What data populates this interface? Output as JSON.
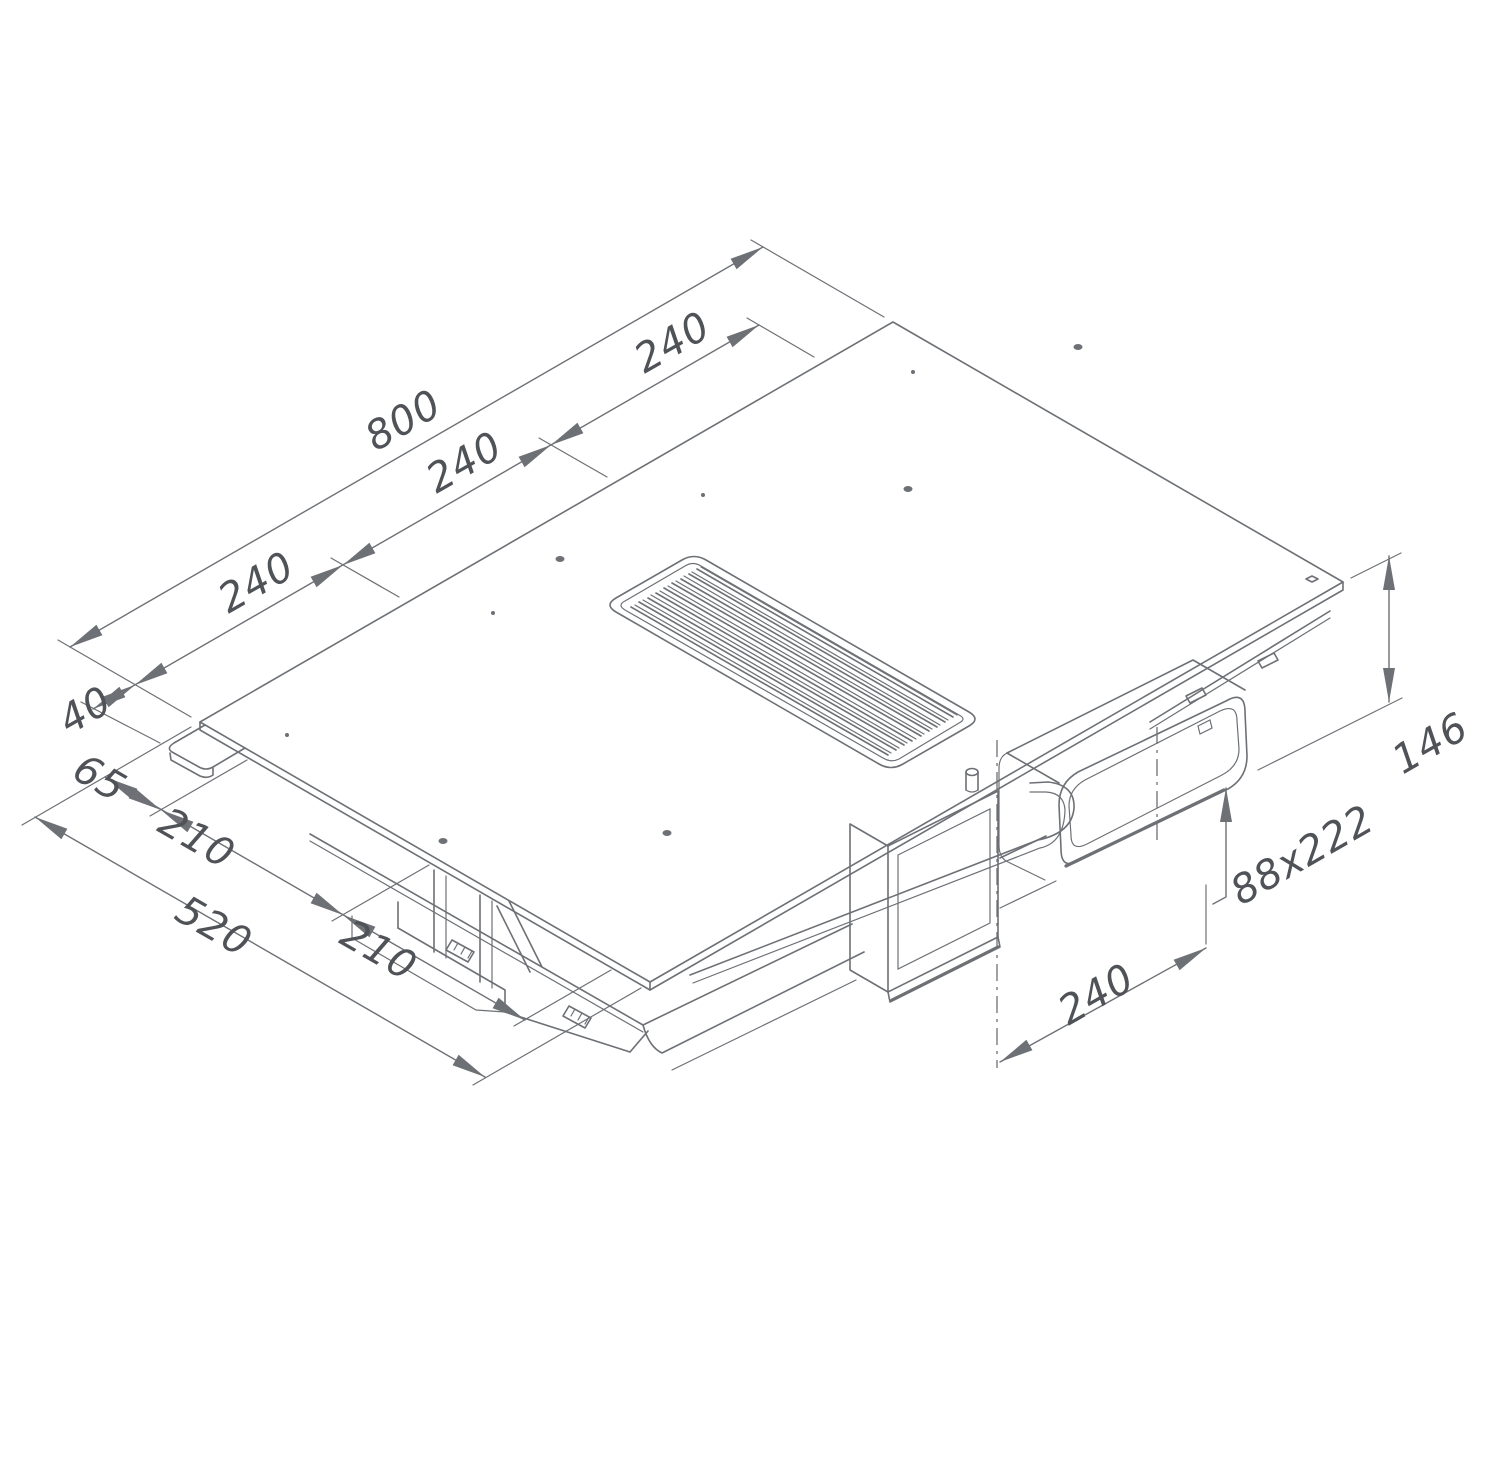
{
  "drawing": {
    "dimensions": {
      "overall_width": "800",
      "zone_pitch_left": "240",
      "zone_pitch_center": "240",
      "zone_pitch_right": "240",
      "left_edge_offset": "40",
      "rear_overhang": "65",
      "body_section_rear": "210",
      "body_section_front": "210",
      "overall_depth": "520",
      "overall_height": "146",
      "duct_cross_section": "88x222",
      "duct_center_offset": "240"
    },
    "colors": {
      "line": "#6d7075",
      "text": "#4f5257",
      "background": "#ffffff"
    }
  }
}
